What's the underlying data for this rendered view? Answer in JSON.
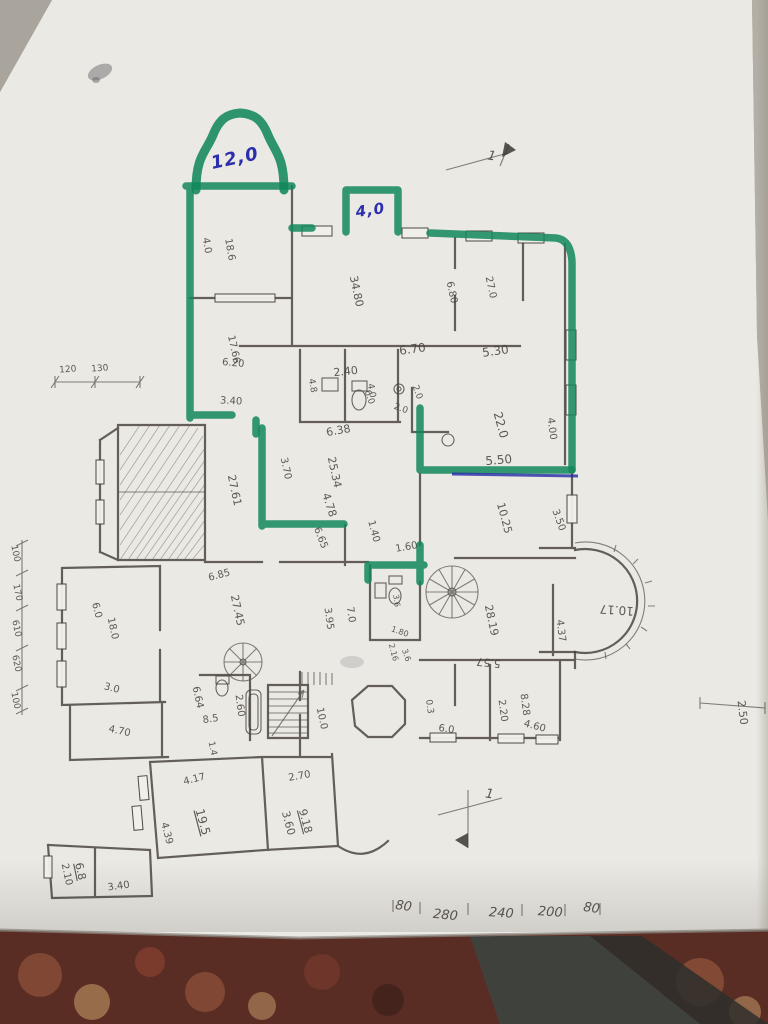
{
  "colors": {
    "marker_green": "#12875c",
    "ink_blue": "#2b2fae",
    "pencil_gray": "#45403b",
    "paper": "#ebe9e4",
    "carpet": "#5a2d24"
  },
  "handwritten_annotations": {
    "bell_bay_area": "12,0",
    "small_bay_area": "4,0"
  },
  "section_marks": [
    "1",
    "1"
  ],
  "dimension_chains": {
    "bottom": [
      "80",
      "280",
      "240",
      "200",
      "80"
    ],
    "left": [
      "100",
      "170",
      "610",
      "620",
      "100"
    ],
    "top_left": [
      "120",
      "130"
    ],
    "right": [
      "2.50"
    ]
  },
  "labels": [
    {
      "t": "12,0",
      "x": 236,
      "y": 164,
      "r": -12,
      "s": 18,
      "c": "ink"
    },
    {
      "t": "4,0",
      "x": 371,
      "y": 215,
      "r": -8,
      "s": 15,
      "c": "ink"
    },
    {
      "t": "4.0",
      "x": 204,
      "y": 246,
      "r": 80
    },
    {
      "t": "18.6",
      "x": 227,
      "y": 250,
      "r": 80
    },
    {
      "t": "34.80",
      "x": 353,
      "y": 292,
      "r": 78,
      "s": 11
    },
    {
      "t": "6.80",
      "x": 449,
      "y": 293,
      "r": 78
    },
    {
      "t": "27.0",
      "x": 488,
      "y": 288,
      "r": 78
    },
    {
      "t": "17.66",
      "x": 231,
      "y": 350,
      "r": 78
    },
    {
      "t": "6.20",
      "x": 233,
      "y": 366,
      "r": 5
    },
    {
      "t": "6.70",
      "x": 413,
      "y": 353,
      "r": -8,
      "s": 12
    },
    {
      "t": "2.40",
      "x": 346,
      "y": 375,
      "r": -6,
      "s": 11
    },
    {
      "t": "4.8",
      "x": 310,
      "y": 386,
      "r": 80,
      "s": 9
    },
    {
      "t": "3.40",
      "x": 231,
      "y": 404,
      "r": 3
    },
    {
      "t": "4.0",
      "x": 369,
      "y": 391,
      "r": 80,
      "s": 9
    },
    {
      "t": "2.0",
      "x": 415,
      "y": 393,
      "r": 70,
      "s": 9
    },
    {
      "t": "2.0",
      "x": 400,
      "y": 411,
      "r": 20,
      "s": 9
    },
    {
      "t": "6.0",
      "x": 367,
      "y": 398,
      "r": 70,
      "s": 9
    },
    {
      "t": "6.38",
      "x": 339,
      "y": 434,
      "r": -10,
      "s": 11
    },
    {
      "t": "25.34",
      "x": 331,
      "y": 473,
      "r": 78,
      "s": 11
    },
    {
      "t": "3.70",
      "x": 283,
      "y": 469,
      "r": 78
    },
    {
      "t": "4.78",
      "x": 326,
      "y": 506,
      "r": 72,
      "s": 11
    },
    {
      "t": "27.61",
      "x": 231,
      "y": 491,
      "r": 78,
      "s": 11
    },
    {
      "t": "6.65",
      "x": 318,
      "y": 539,
      "r": 68
    },
    {
      "t": "5.30",
      "x": 496,
      "y": 355,
      "r": -8,
      "s": 12
    },
    {
      "t": "22.0",
      "x": 497,
      "y": 426,
      "r": 75,
      "s": 12
    },
    {
      "t": "4.00",
      "x": 549,
      "y": 429,
      "r": 83
    },
    {
      "t": "5.50",
      "x": 499,
      "y": 464,
      "r": -5,
      "s": 12
    },
    {
      "t": "10.25",
      "x": 501,
      "y": 519,
      "r": 75,
      "s": 11
    },
    {
      "t": "3.50",
      "x": 556,
      "y": 521,
      "r": 70
    },
    {
      "t": "1.60",
      "x": 407,
      "y": 550,
      "r": -10
    },
    {
      "t": "1.40",
      "x": 371,
      "y": 532,
      "r": 75
    },
    {
      "t": "6.85",
      "x": 220,
      "y": 578,
      "r": -15
    },
    {
      "t": "27.45",
      "x": 234,
      "y": 611,
      "r": 78,
      "s": 11
    },
    {
      "t": "3.95",
      "x": 326,
      "y": 619,
      "r": 82
    },
    {
      "t": "7.0",
      "x": 348,
      "y": 615,
      "r": 82
    },
    {
      "t": "6.0",
      "x": 94,
      "y": 611,
      "r": 75
    },
    {
      "t": "18.0",
      "x": 110,
      "y": 629,
      "r": 78
    },
    {
      "t": "3.0",
      "x": 111,
      "y": 691,
      "r": 15
    },
    {
      "t": "4.70",
      "x": 119,
      "y": 734,
      "r": 12
    },
    {
      "t": "6.64",
      "x": 195,
      "y": 698,
      "r": 78
    },
    {
      "t": "8.5",
      "x": 211,
      "y": 722,
      "r": -8
    },
    {
      "t": "2.60",
      "x": 237,
      "y": 706,
      "r": 82
    },
    {
      "t": "10.0",
      "x": 319,
      "y": 719,
      "r": 78
    },
    {
      "t": "1.4",
      "x": 210,
      "y": 749,
      "r": 78,
      "s": 9
    },
    {
      "t": "4.17",
      "x": 195,
      "y": 782,
      "r": -14
    },
    {
      "t": "19.5",
      "x": 199,
      "y": 823,
      "r": 75,
      "s": 12,
      "u": 1
    },
    {
      "t": "2.70",
      "x": 300,
      "y": 779,
      "r": -10
    },
    {
      "t": "9.18",
      "x": 302,
      "y": 822,
      "r": 75,
      "s": 11,
      "u": 1
    },
    {
      "t": "3.60",
      "x": 285,
      "y": 824,
      "r": 75,
      "s": 11
    },
    {
      "t": "4.39",
      "x": 164,
      "y": 834,
      "r": 75
    },
    {
      "t": "6.8",
      "x": 77,
      "y": 872,
      "r": 78,
      "s": 11,
      "u": 1
    },
    {
      "t": "2.10",
      "x": 64,
      "y": 875,
      "r": 78
    },
    {
      "t": "3.40",
      "x": 119,
      "y": 889,
      "r": -8
    },
    {
      "t": "28.19",
      "x": 488,
      "y": 621,
      "r": 78,
      "s": 11
    },
    {
      "t": "4.37",
      "x": 558,
      "y": 631,
      "r": 83
    },
    {
      "t": "5.57",
      "x": 489,
      "y": 659,
      "r": 186,
      "s": 11
    },
    {
      "t": "2.20",
      "x": 500,
      "y": 711,
      "r": 82
    },
    {
      "t": "8.28",
      "x": 522,
      "y": 705,
      "r": 82
    },
    {
      "t": "4.60",
      "x": 534,
      "y": 729,
      "r": 15
    },
    {
      "t": "6.0",
      "x": 446,
      "y": 732,
      "r": 8
    },
    {
      "t": "0.3",
      "x": 427,
      "y": 707,
      "r": 82,
      "s": 9
    },
    {
      "t": "10.17",
      "x": 617,
      "y": 606,
      "r": 184,
      "s": 12
    },
    {
      "t": "2.50",
      "x": 739,
      "y": 713,
      "r": 83,
      "s": 11
    },
    {
      "t": "3.6",
      "x": 394,
      "y": 601,
      "r": 82,
      "s": 8
    },
    {
      "t": "1.80",
      "x": 399,
      "y": 634,
      "r": 20,
      "s": 8
    },
    {
      "t": "2.16",
      "x": 391,
      "y": 653,
      "r": 75,
      "s": 8
    },
    {
      "t": "3.6",
      "x": 404,
      "y": 656,
      "r": 70,
      "s": 8
    },
    {
      "t": "80",
      "x": 403,
      "y": 910,
      "r": 8,
      "s": 13,
      "c": "hand"
    },
    {
      "t": "280",
      "x": 445,
      "y": 919,
      "r": 6,
      "s": 13,
      "c": "hand"
    },
    {
      "t": "240",
      "x": 501,
      "y": 917,
      "r": 4,
      "s": 13,
      "c": "hand"
    },
    {
      "t": "200",
      "x": 550,
      "y": 916,
      "r": 4,
      "s": 13,
      "c": "hand"
    },
    {
      "t": "80",
      "x": 591,
      "y": 912,
      "r": 8,
      "s": 13,
      "c": "hand"
    },
    {
      "t": "100",
      "x": 13,
      "y": 554,
      "r": 78,
      "s": 9
    },
    {
      "t": "170",
      "x": 15,
      "y": 593,
      "r": 78,
      "s": 9
    },
    {
      "t": "610",
      "x": 14,
      "y": 629,
      "r": 78,
      "s": 9
    },
    {
      "t": "620",
      "x": 14,
      "y": 664,
      "r": 78,
      "s": 9
    },
    {
      "t": "100",
      "x": 13,
      "y": 701,
      "r": 78,
      "s": 9
    },
    {
      "t": "120",
      "x": 68,
      "y": 372,
      "r": -4,
      "s": 9
    },
    {
      "t": "130",
      "x": 100,
      "y": 371,
      "r": -4,
      "s": 9
    },
    {
      "t": "1",
      "x": 491,
      "y": 160,
      "r": 10,
      "s": 13,
      "c": "hand"
    },
    {
      "t": "1",
      "x": 489,
      "y": 798,
      "r": 8,
      "s": 13,
      "c": "hand"
    }
  ]
}
